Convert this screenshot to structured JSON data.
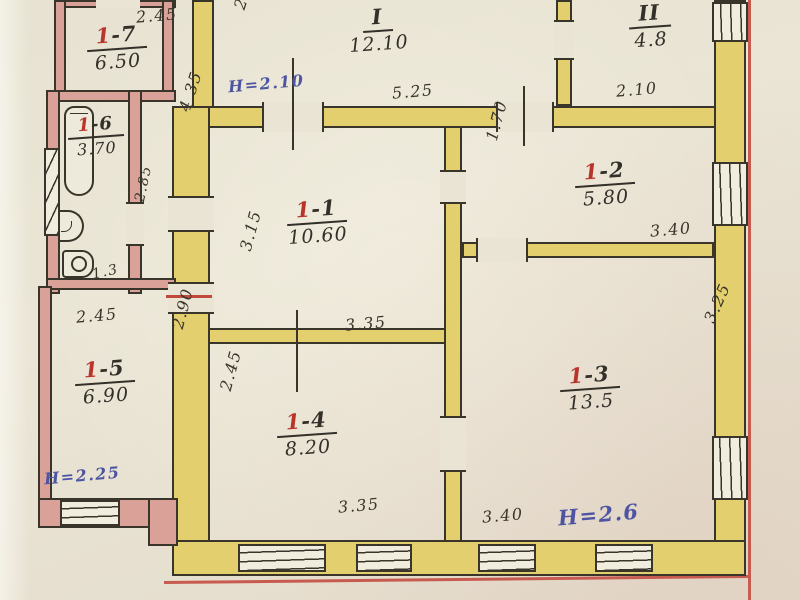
{
  "plan": {
    "title": "hand-drawn floor plan (scanned technical passport sheet)",
    "rooms": [
      {
        "red": "",
        "rest": "I",
        "area": "12.10"
      },
      {
        "red": "",
        "rest": "II",
        "area": "4.8"
      },
      {
        "red": "1",
        "rest": "-1",
        "area": "10.60"
      },
      {
        "red": "1",
        "rest": "-2",
        "area": "5.80"
      },
      {
        "red": "1",
        "rest": "-3",
        "area": "13.5"
      },
      {
        "red": "1",
        "rest": "-4",
        "area": "8.20"
      },
      {
        "red": "1",
        "rest": "-5",
        "area": "6.90"
      },
      {
        "red": "1",
        "rest": "-6",
        "area": "3.70"
      },
      {
        "red": "1",
        "rest": "-7",
        "area": "6.50"
      }
    ],
    "dimensions": [
      {
        "text": "2.45"
      },
      {
        "text": "2.3"
      },
      {
        "text": "5.25"
      },
      {
        "text": "2.10"
      },
      {
        "text": "1.70"
      },
      {
        "text": "3.40"
      },
      {
        "text": "3.25"
      },
      {
        "text": "4.35"
      },
      {
        "text": "3.15"
      },
      {
        "text": "3.35"
      },
      {
        "text": "2.85"
      },
      {
        "text": "1.3"
      },
      {
        "text": "2.45"
      },
      {
        "text": "2.90"
      },
      {
        "text": "2.45"
      },
      {
        "text": "3.35"
      },
      {
        "text": "3.40"
      }
    ],
    "heights": [
      {
        "text": "H=2.10"
      },
      {
        "text": "H=2.25"
      },
      {
        "text": "H=2.6"
      }
    ],
    "colors": {
      "paper": "#e9e4d4",
      "wall_yellow": "#e4cf6e",
      "wall_pink": "#d9a198",
      "ink": "#3a352a",
      "room_number_red": "#b8352c",
      "height_blue": "#4d55a3",
      "frame_red": "#c75b50"
    },
    "fixtures": [
      {
        "name": "bathtub"
      },
      {
        "name": "sink"
      },
      {
        "name": "toilet"
      }
    ]
  }
}
